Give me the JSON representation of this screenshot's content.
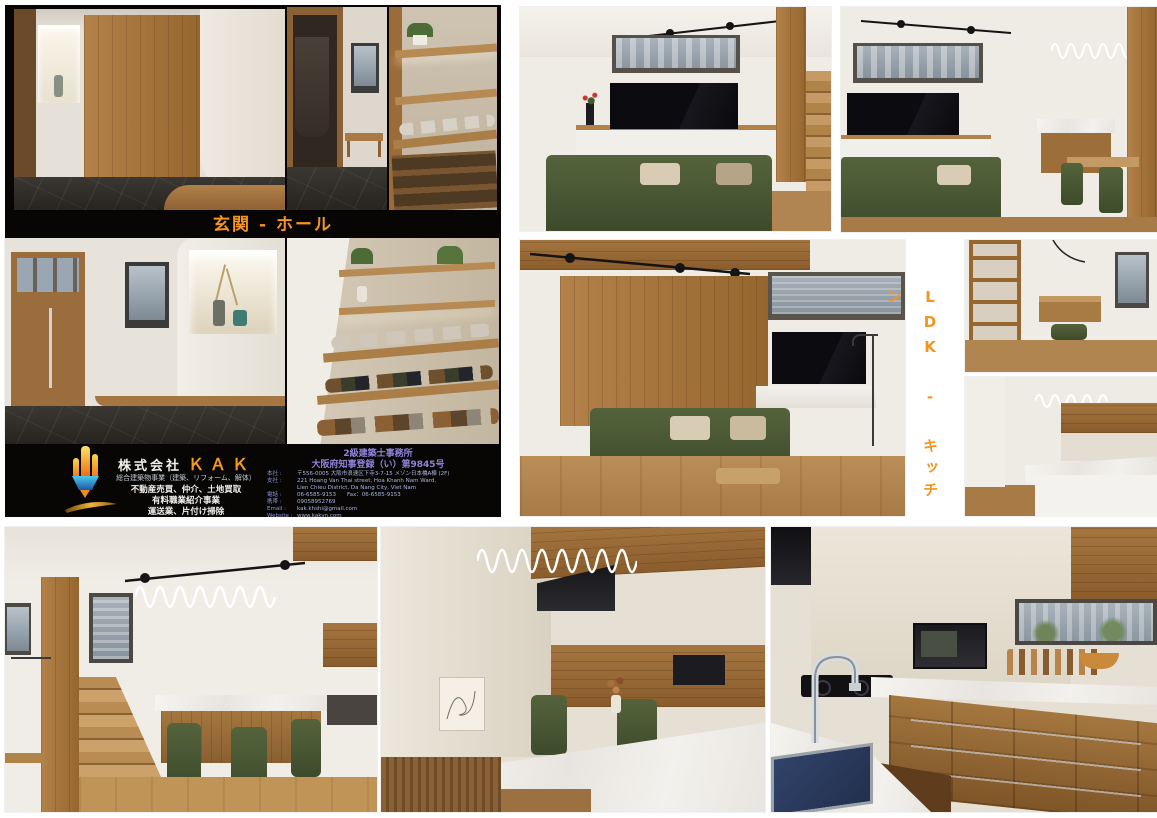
{
  "sections": {
    "genkan_label": "玄関 - ホール",
    "ldk_label": "LDK - キッチン",
    "label_color": "#F5941E"
  },
  "company": {
    "name_prefix": "株式会社",
    "name": "ＫＡＫ",
    "services": [
      "総合建築物事業（建築、リフォーム、解体）",
      "不動産売買、仲介、土地買取",
      "有料職業紹介事業",
      "運送業、片付け掃除"
    ],
    "license": {
      "line1": "2級建築士事務所",
      "line2": "大阪府知事登録（い）第9845号"
    },
    "details": [
      {
        "label": "本社 :",
        "value": "〒556-0005 大阪市浪速区下寺3-7-15 メゾン日本橋A棟 (2F)"
      },
      {
        "label": "支社 :",
        "value": "221 Hoang Van Thai street, Hoa Khanh Nam Ward,"
      },
      {
        "label": "",
        "value": "Lien Chieu District, Da Nang City, Viet Nam"
      },
      {
        "label": "電話 :",
        "value": "06-6585-9153　　Fax：06-6585-9153"
      },
      {
        "label": "携帯 :",
        "value": "09058952769"
      },
      {
        "label": "Email :",
        "value": "kak.khshi@gmail.com"
      },
      {
        "label": "Website :",
        "value": "www.kakvn.com"
      }
    ]
  },
  "photos": {
    "a": "entrance-hall-sliding-door",
    "b": "coat-closet-bench",
    "c": "shoe-shelf-slippers",
    "d": "entrance-door-niche",
    "e": "shoe-rack-display",
    "f": "living-room-tv-stairs",
    "g": "living-room-wood-wall",
    "h": "ldk-overview-dining",
    "i": "study-nook-shelf",
    "j": "kitchen-island-view",
    "p1": "dining-stairs-pendant",
    "p2": "dining-island-closeup",
    "p3": "kitchen-sink-cabinets"
  }
}
